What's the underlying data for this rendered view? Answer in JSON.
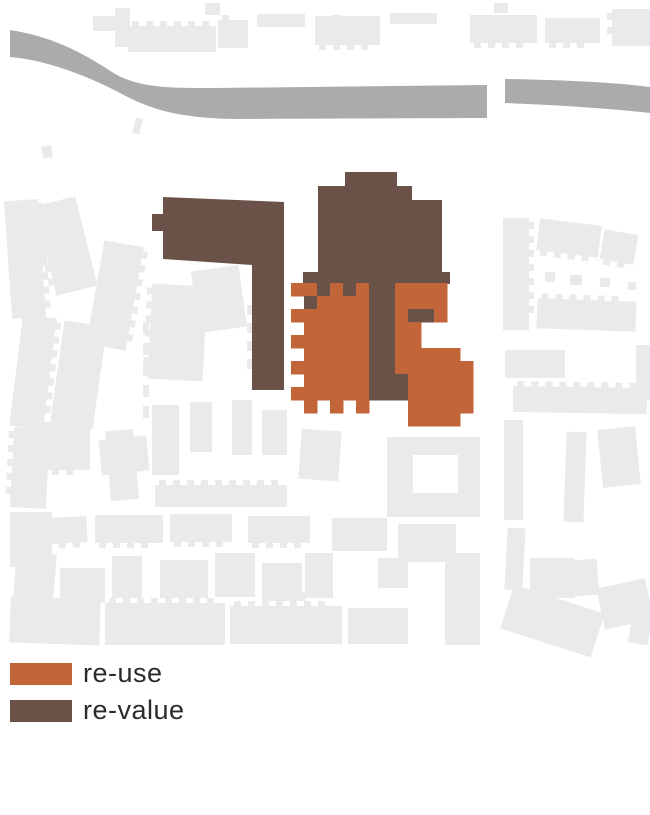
{
  "colors": {
    "bg": "#ffffff",
    "orange": "#C2663A",
    "brown": "#6B5248",
    "road": "#ACAAAD",
    "building": "#EAEAEC",
    "text": "#2b2b2b"
  },
  "legend": {
    "items": [
      {
        "label": "re-use",
        "color_key": "orange"
      },
      {
        "label": "re-value",
        "color_key": "brown"
      }
    ]
  },
  "map": {
    "roads": [
      "M10,30 C50,36 82,52 112,72 C138,89 175,88 215,88 L487,85 L487,118 L235,119 C180,118 152,110 122,94 C92,78 48,60 10,57 Z",
      "M505,79 C560,80 610,82 650,87 L650,113 C605,108 555,105 505,103 Z"
    ],
    "revalue_shapes": [
      "M345,172 L397,172 L397,186 L412,186 L412,200 L442,200 L442,272 L450,272 L450,284 L303,284 L303,272 L318,272 L318,186 L345,186 Z",
      "M163,197 L284,202 L284,390 L252,390 L252,265 L163,259 Z",
      "M152,214 L164,214 L164,231 L152,231 Z"
    ],
    "grid": {
      "origin": [
        291,
        283
      ],
      "cell": 13,
      "cell_legend": {
        "O": "orange",
        "B": "brown",
        ".": null
      },
      "rows": [
        "OOBOBOBBOOOO..",
        ".BOOOOBBOOOO..",
        "OOOOOOBBOBBO..",
        ".OOOOOBBOO....",
        "OOOOOOBBOO....",
        ".OOOOOBBOOOOO.",
        "OOOOOOBBOOOOOO",
        ".OOOOOBBBOOOOO",
        "OOOOOOBBBOOOOO",
        ".O.O.O...OOOOO",
        ".........OOOO."
      ]
    },
    "background_buildings": [
      {
        "x": 115,
        "y": 8,
        "w": 15,
        "h": 39
      },
      {
        "x": 93,
        "y": 16,
        "w": 28,
        "h": 15
      },
      {
        "x": 128,
        "y": 26,
        "w": 88,
        "h": 26,
        "c": "top"
      },
      {
        "x": 218,
        "y": 20,
        "w": 30,
        "h": 28,
        "c": "top"
      },
      {
        "x": 257,
        "y": 14,
        "w": 48,
        "h": 13
      },
      {
        "x": 205,
        "y": 3,
        "w": 15,
        "h": 12
      },
      {
        "x": 315,
        "y": 16,
        "w": 65,
        "h": 29,
        "c": "bottom"
      },
      {
        "x": 390,
        "y": 13,
        "w": 47,
        "h": 11
      },
      {
        "x": 470,
        "y": 15,
        "w": 67,
        "h": 28,
        "c": "bottom"
      },
      {
        "x": 545,
        "y": 18,
        "w": 55,
        "h": 25,
        "c": "bottom"
      },
      {
        "x": 612,
        "y": 9,
        "w": 38,
        "h": 37,
        "c": "left"
      },
      {
        "x": 494,
        "y": 3,
        "w": 14,
        "h": 10
      },
      {
        "x": 332,
        "y": 15,
        "w": 10,
        "h": 10
      },
      {
        "x": 8,
        "y": 200,
        "w": 34,
        "h": 118,
        "r": -4,
        "c": "right"
      },
      {
        "x": 16,
        "y": 316,
        "w": 34,
        "h": 112,
        "r": 7,
        "c": "right"
      },
      {
        "x": 45,
        "y": 200,
        "w": 42,
        "h": 92,
        "r": -14,
        "c": "left"
      },
      {
        "x": 95,
        "y": 243,
        "w": 40,
        "h": 105,
        "r": 10,
        "c": "right"
      },
      {
        "x": 57,
        "y": 323,
        "w": 43,
        "h": 104,
        "r": 8
      },
      {
        "x": 12,
        "y": 428,
        "w": 36,
        "h": 80,
        "r": 3,
        "c": "left"
      },
      {
        "x": 10,
        "y": 512,
        "w": 42,
        "h": 55
      },
      {
        "x": 108,
        "y": 430,
        "w": 28,
        "h": 70,
        "r": -5
      },
      {
        "x": 134,
        "y": 118,
        "w": 7,
        "h": 16,
        "r": 15
      },
      {
        "x": 42,
        "y": 146,
        "w": 10,
        "h": 12,
        "r": -10
      },
      {
        "x": 150,
        "y": 285,
        "w": 55,
        "h": 95,
        "r": 3,
        "c": "left"
      },
      {
        "x": 195,
        "y": 268,
        "w": 48,
        "h": 62,
        "r": -8
      },
      {
        "x": 152,
        "y": 405,
        "w": 27,
        "h": 70
      },
      {
        "x": 190,
        "y": 402,
        "w": 22,
        "h": 50
      },
      {
        "x": 232,
        "y": 400,
        "w": 20,
        "h": 55
      },
      {
        "x": 262,
        "y": 410,
        "w": 25,
        "h": 45
      },
      {
        "x": 155,
        "y": 485,
        "w": 132,
        "h": 22,
        "c": "top"
      },
      {
        "x": 387,
        "y": 437,
        "w": 93,
        "h": 80
      },
      {
        "x": 413,
        "y": 455,
        "w": 45,
        "h": 38,
        "fill": "bg"
      },
      {
        "x": 504,
        "y": 420,
        "w": 19,
        "h": 100
      },
      {
        "x": 506,
        "y": 528,
        "w": 18,
        "h": 62,
        "r": 3
      },
      {
        "x": 565,
        "y": 432,
        "w": 20,
        "h": 90,
        "r": 2
      },
      {
        "x": 600,
        "y": 428,
        "w": 38,
        "h": 58,
        "r": -6
      },
      {
        "x": 503,
        "y": 218,
        "w": 26,
        "h": 112,
        "c": "right"
      },
      {
        "x": 538,
        "y": 222,
        "w": 62,
        "h": 32,
        "r": 7,
        "c": "bottom"
      },
      {
        "x": 602,
        "y": 232,
        "w": 34,
        "h": 30,
        "r": 10,
        "c": "bottom"
      },
      {
        "x": 537,
        "y": 300,
        "w": 99,
        "h": 30,
        "r": 2,
        "c": "top"
      },
      {
        "x": 545,
        "y": 272,
        "w": 10,
        "h": 10
      },
      {
        "x": 570,
        "y": 275,
        "w": 12,
        "h": 10
      },
      {
        "x": 600,
        "y": 278,
        "w": 10,
        "h": 9
      },
      {
        "x": 628,
        "y": 282,
        "w": 8,
        "h": 8
      },
      {
        "x": 513,
        "y": 387,
        "w": 134,
        "h": 26,
        "r": 1,
        "c": "top"
      },
      {
        "x": 505,
        "y": 350,
        "w": 60,
        "h": 28
      },
      {
        "x": 636,
        "y": 345,
        "w": 14,
        "h": 55
      },
      {
        "x": 34,
        "y": 422,
        "w": 56,
        "h": 48,
        "c": "bottom"
      },
      {
        "x": 100,
        "y": 438,
        "w": 48,
        "h": 35,
        "r": -6
      },
      {
        "x": 300,
        "y": 430,
        "w": 40,
        "h": 50,
        "r": 4
      },
      {
        "x": 12,
        "y": 518,
        "w": 75,
        "h": 26,
        "r": -3,
        "c": "bottom"
      },
      {
        "x": 95,
        "y": 515,
        "w": 68,
        "h": 28,
        "c": "bottom"
      },
      {
        "x": 170,
        "y": 514,
        "w": 62,
        "h": 28,
        "c": "bottom"
      },
      {
        "x": 248,
        "y": 516,
        "w": 62,
        "h": 27,
        "c": "bottom"
      },
      {
        "x": 332,
        "y": 518,
        "w": 55,
        "h": 33
      },
      {
        "x": 398,
        "y": 524,
        "w": 58,
        "h": 38
      },
      {
        "x": 15,
        "y": 553,
        "w": 40,
        "h": 45,
        "r": 5
      },
      {
        "x": 60,
        "y": 568,
        "w": 45,
        "h": 35
      },
      {
        "x": 112,
        "y": 556,
        "w": 30,
        "h": 42
      },
      {
        "x": 160,
        "y": 560,
        "w": 48,
        "h": 38
      },
      {
        "x": 215,
        "y": 553,
        "w": 40,
        "h": 44
      },
      {
        "x": 262,
        "y": 563,
        "w": 40,
        "h": 38
      },
      {
        "x": 305,
        "y": 553,
        "w": 28,
        "h": 45
      },
      {
        "x": 378,
        "y": 558,
        "w": 30,
        "h": 30
      },
      {
        "x": 445,
        "y": 553,
        "w": 35,
        "h": 92
      },
      {
        "x": 530,
        "y": 558,
        "w": 45,
        "h": 40
      },
      {
        "x": 558,
        "y": 560,
        "w": 40,
        "h": 36,
        "r": -4
      },
      {
        "x": 10,
        "y": 598,
        "w": 90,
        "h": 46,
        "r": 2
      },
      {
        "x": 105,
        "y": 603,
        "w": 120,
        "h": 42,
        "c": "top"
      },
      {
        "x": 230,
        "y": 606,
        "w": 112,
        "h": 38,
        "c": "top"
      },
      {
        "x": 348,
        "y": 608,
        "w": 60,
        "h": 36
      },
      {
        "x": 505,
        "y": 598,
        "w": 95,
        "h": 46,
        "r": 18
      },
      {
        "x": 600,
        "y": 583,
        "w": 50,
        "h": 42,
        "r": -12
      },
      {
        "x": 630,
        "y": 618,
        "w": 20,
        "h": 26,
        "r": 10
      }
    ],
    "dash_lines": [
      {
        "x": 143,
        "y": 322,
        "len": 100,
        "seg": 12,
        "gap": 9,
        "w": 6
      },
      {
        "x": 247,
        "y": 305,
        "len": 65,
        "seg": 10,
        "gap": 8,
        "w": 5
      },
      {
        "x": 300,
        "y": 592,
        "len": 52,
        "seg": 9,
        "gap": 8,
        "w": 5
      }
    ]
  }
}
